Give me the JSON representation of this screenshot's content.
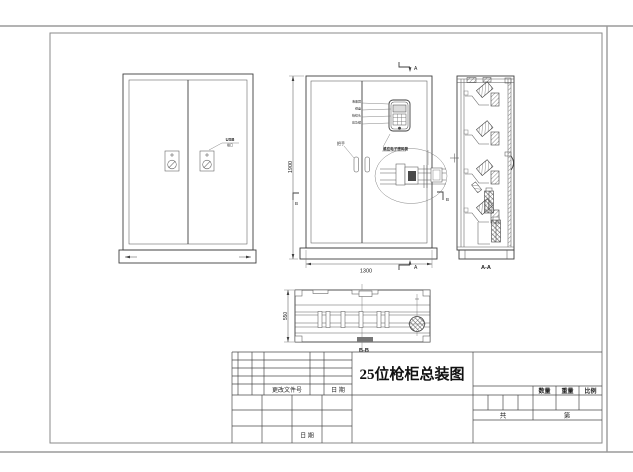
{
  "sheet": {
    "title": "25位枪柜总装图",
    "dimensions": {
      "height": "1900",
      "width": "1300",
      "depth": "550"
    },
    "section_labels": {
      "side": "A-A",
      "bottom": "B-B",
      "a_top": "A",
      "a_bottom": "A",
      "b_left": "B",
      "b_right": "B"
    },
    "annotations": {
      "usb_note_line1": "USB",
      "usb_note_line2": "插口",
      "handle": "把手",
      "lock_note": "感应电子密码锁",
      "callouts": [
        "液晶屏",
        "键盘",
        "指纹头",
        "应急锁"
      ]
    }
  },
  "title_block": {
    "change_file_no": "更改文件号",
    "date": "日 期",
    "date_bottom": "日 期",
    "quantity": "数量",
    "weight": "重量",
    "scale": "比例",
    "total": "共",
    "sheet_no": "第"
  }
}
